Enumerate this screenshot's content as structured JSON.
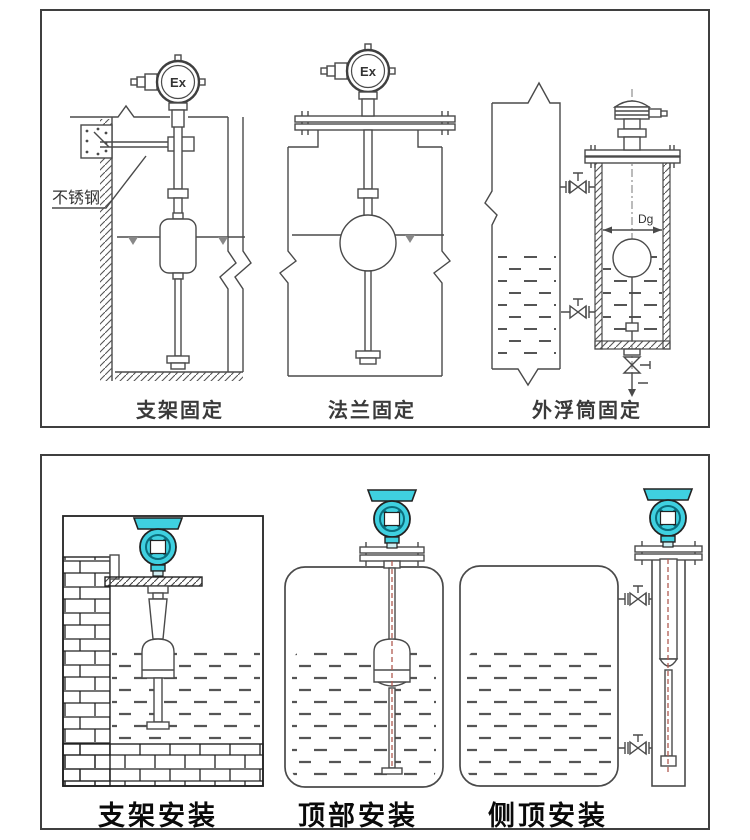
{
  "colors": {
    "accent_teal": "#3fd0e0",
    "teal_dark": "#0b6d7c",
    "line": "#4a4a4a",
    "centerline_red": "#b05a50",
    "liquid": "#555555"
  },
  "top_panel": {
    "diagrams": [
      {
        "id": "bracket-fixing",
        "caption": "支架固定",
        "head_label": "Ex",
        "annotation": "不锈钢"
      },
      {
        "id": "flange-fixing",
        "caption": "法兰固定",
        "head_label": "Ex"
      },
      {
        "id": "external-float-chamber-fixing",
        "caption": "外浮筒固定",
        "dimension_label": "Dg"
      }
    ]
  },
  "bottom_panel": {
    "diagrams": [
      {
        "id": "bracket-installation",
        "caption": "支架安装"
      },
      {
        "id": "top-installation",
        "caption": "顶部安装"
      },
      {
        "id": "side-top-installation",
        "caption": "侧顶安装"
      }
    ]
  }
}
